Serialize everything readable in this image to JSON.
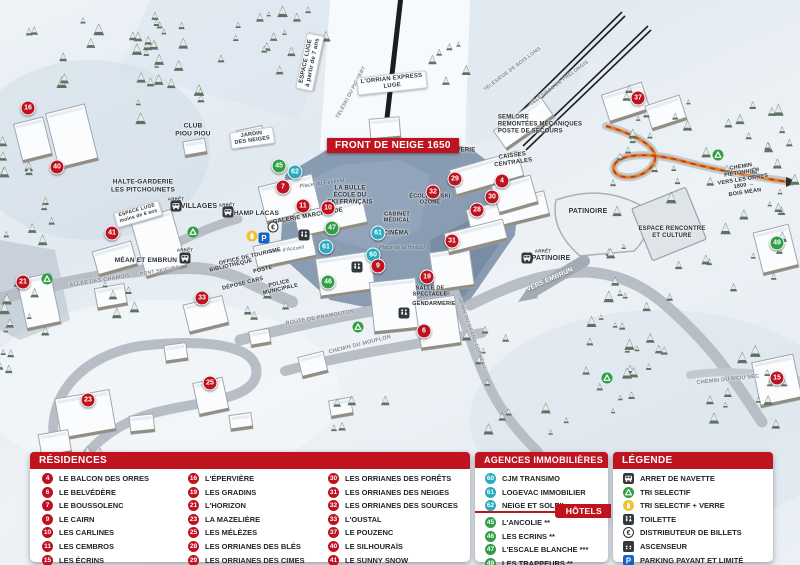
{
  "colors": {
    "red": "#bd1220",
    "teal": "#2aabbd",
    "green": "#2f9e45",
    "accent": "#c01320",
    "orange_path": "#e2801f"
  },
  "map": {
    "banner": "FRONT DE NEIGE 1650",
    "labels": [
      {
        "t": "ESPACE LUGE\nà partir de 7 ans",
        "x": 310,
        "y": 62,
        "rot": -78,
        "fs": 6,
        "cls": "s"
      },
      {
        "t": "TÉLÉSKI DU PIC VERT",
        "x": 352,
        "y": 93,
        "rot": -62,
        "fs": 5,
        "cls": "r"
      },
      {
        "t": "L'ORRIAN EXPRESS\nLUGE",
        "x": 392,
        "y": 83,
        "rot": -6,
        "fs": 6,
        "cls": "s"
      },
      {
        "t": "TÉLÉSIÈGE DE BOIS LONG",
        "x": 513,
        "y": 70,
        "rot": -37,
        "fs": 5,
        "cls": "r"
      },
      {
        "t": "TÉLÉSIÈGE DE PRÉLONGIS",
        "x": 560,
        "y": 84,
        "rot": -37,
        "fs": 5,
        "cls": "r"
      },
      {
        "t": "SEMLORE\nREMONTÉES MÉCANIQUES\nPOSTE DE SECOURS",
        "x": 540,
        "y": 125,
        "fs": 6,
        "cls": "d l"
      },
      {
        "t": "CLUB\nPIOU PIOU",
        "x": 193,
        "y": 130,
        "fs": 6.5,
        "cls": "d"
      },
      {
        "t": "JARDIN\nDES NEIGES",
        "x": 252,
        "y": 138,
        "rot": -8,
        "fs": 5.5,
        "cls": "s"
      },
      {
        "t": "HALTE-GARDERIE\nLES PITCHOUNETS",
        "x": 143,
        "y": 186,
        "fs": 6.5,
        "cls": "d"
      },
      {
        "t": "ESPACE LUGE\nmoins de 6 ans",
        "x": 138,
        "y": 214,
        "rot": -16,
        "fs": 5,
        "cls": "s"
      },
      {
        "t": "ARRÊT",
        "x": 176,
        "y": 199,
        "fs": 4.5,
        "cls": "a"
      },
      {
        "t": "VILLAGES",
        "x": 199,
        "y": 207,
        "fs": 7,
        "cls": "d"
      },
      {
        "t": "ARRÊT",
        "x": 227,
        "y": 205,
        "fs": 4.5,
        "cls": "a"
      },
      {
        "t": "CHAMP LACAS",
        "x": 254,
        "y": 214,
        "fs": 6.5,
        "cls": "d"
      },
      {
        "t": "Place du Festival",
        "x": 322,
        "y": 184,
        "rot": -8,
        "fs": 5.5,
        "cls": "i"
      },
      {
        "t": "LA BULLE\nÉCOLE DU\nSKI FRANÇAIS",
        "x": 350,
        "y": 196,
        "fs": 6,
        "cls": "d"
      },
      {
        "t": "GALERIE MARCHANDE",
        "x": 308,
        "y": 217,
        "rot": -10,
        "fs": 6,
        "cls": "d"
      },
      {
        "t": "CAISSES\nCENTRALES",
        "x": 513,
        "y": 160,
        "rot": -8,
        "fs": 6,
        "cls": "d"
      },
      {
        "t": "LAVERIE",
        "x": 462,
        "y": 151,
        "fs": 6,
        "cls": "d"
      },
      {
        "t": "ÉCOLE DE SKI\nOZONE",
        "x": 430,
        "y": 200,
        "fs": 5.5,
        "cls": "d"
      },
      {
        "t": "CABINET\nMÉDICAL",
        "x": 397,
        "y": 218,
        "fs": 5.5,
        "cls": "d"
      },
      {
        "t": "CINÉMA",
        "x": 396,
        "y": 234,
        "fs": 6,
        "cls": "d"
      },
      {
        "t": "Place de la Hodoul",
        "x": 402,
        "y": 249,
        "fs": 5,
        "cls": "i"
      },
      {
        "t": "Place d'Accueil",
        "x": 286,
        "y": 251,
        "rot": -8,
        "fs": 5,
        "cls": "i"
      },
      {
        "t": "OFFICE DE TOURISME",
        "x": 250,
        "y": 257,
        "rot": -13,
        "fs": 5.5,
        "cls": "d"
      },
      {
        "t": "BIBLIOTHÈQUE",
        "x": 231,
        "y": 266,
        "rot": -13,
        "fs": 5.5,
        "cls": "d"
      },
      {
        "t": "POSTE",
        "x": 263,
        "y": 270,
        "rot": -13,
        "fs": 5.5,
        "cls": "d"
      },
      {
        "t": "DÉPOSE CARS",
        "x": 243,
        "y": 284,
        "rot": -14,
        "fs": 5.5,
        "cls": "d"
      },
      {
        "t": "POLICE\nMUNICIPALE",
        "x": 280,
        "y": 287,
        "rot": -13,
        "fs": 5.5,
        "cls": "d"
      },
      {
        "t": "ARRÊT",
        "x": 185,
        "y": 250,
        "fs": 4.5,
        "cls": "a"
      },
      {
        "t": "MÉAN ET EMBRUN",
        "x": 146,
        "y": 261,
        "fs": 6.5,
        "cls": "d"
      },
      {
        "t": "PONT SKIEURS",
        "x": 160,
        "y": 272,
        "rot": -10,
        "fs": 5,
        "cls": "r"
      },
      {
        "t": "ALLÉE DES CHAMOIS",
        "x": 100,
        "y": 281,
        "rot": -9,
        "fs": 5.5,
        "cls": "r"
      },
      {
        "t": "ROUTE DE PRAMOUTON",
        "x": 320,
        "y": 318,
        "rot": -10,
        "fs": 5.5,
        "cls": "r"
      },
      {
        "t": "CHEMIN DU MOUFLON",
        "x": 360,
        "y": 345,
        "rot": -14,
        "fs": 5.5,
        "cls": "r"
      },
      {
        "t": "CHEMIN DU GRAND CORBEAU",
        "x": 470,
        "y": 332,
        "rot": 70,
        "fs": 5,
        "cls": "r"
      },
      {
        "t": "SALLE DE\nSPECTACLE",
        "x": 430,
        "y": 292,
        "fs": 5.5,
        "cls": "d"
      },
      {
        "t": "GENDARMERIE",
        "x": 434,
        "y": 304,
        "fs": 5.5,
        "cls": "d"
      },
      {
        "t": "PATINOIRE",
        "x": 588,
        "y": 212,
        "fs": 7,
        "cls": "d"
      },
      {
        "t": "ARRÊT",
        "x": 543,
        "y": 251,
        "fs": 4.5,
        "cls": "a"
      },
      {
        "t": "PATINOIRE",
        "x": 551,
        "y": 259,
        "fs": 7,
        "cls": "d"
      },
      {
        "t": "ESPACE RENCONTRE\nET CULTURE",
        "x": 672,
        "y": 233,
        "fs": 6,
        "cls": "d"
      },
      {
        "t": "VERS EMBRUN",
        "x": 550,
        "y": 280,
        "rot": -24,
        "fs": 6.5,
        "cls": "w"
      },
      {
        "t": "CHEMIN PIÉTONNIER\nVERS LES ORRES 1800 →\nBOIS MÉAN",
        "x": 743,
        "y": 180,
        "rot": -9,
        "fs": 5.5,
        "cls": "d"
      },
      {
        "t": "CHEMIN DU RIOU SEC",
        "x": 728,
        "y": 380,
        "rot": -6,
        "fs": 5.5,
        "cls": "r"
      }
    ],
    "markers": [
      {
        "n": "16",
        "x": 28,
        "y": 108,
        "c": "red"
      },
      {
        "n": "40",
        "x": 57,
        "y": 167,
        "c": "red"
      },
      {
        "n": "41",
        "x": 112,
        "y": 233,
        "c": "red"
      },
      {
        "n": "21",
        "x": 23,
        "y": 282,
        "c": "red"
      },
      {
        "n": "33",
        "x": 202,
        "y": 298,
        "c": "red"
      },
      {
        "n": "23",
        "x": 88,
        "y": 400,
        "c": "red"
      },
      {
        "n": "25",
        "x": 210,
        "y": 383,
        "c": "red"
      },
      {
        "n": "45",
        "x": 279,
        "y": 166,
        "c": "green"
      },
      {
        "n": "62",
        "x": 295,
        "y": 172,
        "c": "teal"
      },
      {
        "n": "7",
        "x": 283,
        "y": 187,
        "c": "red"
      },
      {
        "n": "11",
        "x": 303,
        "y": 206,
        "c": "red"
      },
      {
        "n": "10",
        "x": 328,
        "y": 208,
        "c": "red"
      },
      {
        "n": "47",
        "x": 332,
        "y": 228,
        "c": "green"
      },
      {
        "n": "61",
        "x": 326,
        "y": 247,
        "c": "teal"
      },
      {
        "n": "61",
        "x": 378,
        "y": 233,
        "c": "teal"
      },
      {
        "n": "60",
        "x": 373,
        "y": 255,
        "c": "teal"
      },
      {
        "n": "9",
        "x": 378,
        "y": 266,
        "c": "red"
      },
      {
        "n": "46",
        "x": 328,
        "y": 282,
        "c": "green"
      },
      {
        "n": "19",
        "x": 427,
        "y": 277,
        "c": "red"
      },
      {
        "n": "6",
        "x": 424,
        "y": 331,
        "c": "red"
      },
      {
        "n": "31",
        "x": 452,
        "y": 241,
        "c": "red"
      },
      {
        "n": "32",
        "x": 433,
        "y": 192,
        "c": "red"
      },
      {
        "n": "29",
        "x": 455,
        "y": 179,
        "c": "red"
      },
      {
        "n": "28",
        "x": 477,
        "y": 210,
        "c": "red"
      },
      {
        "n": "30",
        "x": 492,
        "y": 197,
        "c": "red"
      },
      {
        "n": "4",
        "x": 502,
        "y": 181,
        "c": "red"
      },
      {
        "n": "37",
        "x": 638,
        "y": 98,
        "c": "red"
      },
      {
        "n": "49",
        "x": 777,
        "y": 243,
        "c": "green"
      },
      {
        "n": "15",
        "x": 777,
        "y": 378,
        "c": "red"
      }
    ],
    "icons": [
      {
        "t": "bus",
        "x": 185,
        "y": 258
      },
      {
        "t": "bus",
        "x": 176,
        "y": 206
      },
      {
        "t": "bus",
        "x": 228,
        "y": 212
      },
      {
        "t": "bus",
        "x": 527,
        "y": 258
      },
      {
        "t": "recycle",
        "x": 47,
        "y": 279
      },
      {
        "t": "recycle",
        "x": 193,
        "y": 232
      },
      {
        "t": "recycle",
        "x": 358,
        "y": 327
      },
      {
        "t": "recycle",
        "x": 718,
        "y": 155
      },
      {
        "t": "recycle",
        "x": 607,
        "y": 378
      },
      {
        "t": "yellow",
        "x": 252,
        "y": 236
      },
      {
        "t": "parking",
        "x": 264,
        "y": 238
      },
      {
        "t": "euro",
        "x": 273,
        "y": 227
      },
      {
        "t": "wc",
        "x": 304,
        "y": 235
      },
      {
        "t": "wc",
        "x": 357,
        "y": 267
      },
      {
        "t": "wc",
        "x": 404,
        "y": 313
      }
    ]
  },
  "legend": {
    "residences": {
      "title": "RÉSIDENCES",
      "columns": [
        [
          {
            "n": "4",
            "label": "LE BALCON DES ORRES"
          },
          {
            "n": "6",
            "label": "LE BELVÉDÈRE"
          },
          {
            "n": "7",
            "label": "LE BOUSSOLENC"
          },
          {
            "n": "9",
            "label": "LE CAIRN"
          },
          {
            "n": "10",
            "label": "LES CARLINES"
          },
          {
            "n": "11",
            "label": "LES CEMBROS"
          },
          {
            "n": "15",
            "label": "LES ÉCRINS"
          }
        ],
        [
          {
            "n": "16",
            "label": "L'ÉPERVIÈRE"
          },
          {
            "n": "19",
            "label": "LES GRADINS"
          },
          {
            "n": "21",
            "label": "L'HORIZON"
          },
          {
            "n": "23",
            "label": "LA MAZELIÈRE"
          },
          {
            "n": "25",
            "label": "LES MÉLÈZES"
          },
          {
            "n": "28",
            "label": "LES ORRIANES DES BLÉS"
          },
          {
            "n": "29",
            "label": "LES ORRIANES DES CIMES"
          }
        ],
        [
          {
            "n": "30",
            "label": "LES ORRIANES DES FORÊTS"
          },
          {
            "n": "31",
            "label": "LES ORRIANES DES NEIGES"
          },
          {
            "n": "32",
            "label": "LES ORRIANES DES SOURCES"
          },
          {
            "n": "33",
            "label": "L'OUSTAL"
          },
          {
            "n": "37",
            "label": "LE POUZENC"
          },
          {
            "n": "40",
            "label": "LE SILHOURAÏS"
          },
          {
            "n": "41",
            "label": "LE SUNNY SNOW"
          }
        ]
      ]
    },
    "agences": {
      "title": "AGENCES IMMOBILIÈRES",
      "items": [
        {
          "n": "60",
          "label": "CJM TRANSIMO"
        },
        {
          "n": "61",
          "label": "LOGEVAC IMMOBILIER"
        },
        {
          "n": "62",
          "label": "NEIGE ET SOLEIL"
        }
      ]
    },
    "hotels": {
      "title": "HÔTELS",
      "items": [
        {
          "n": "45",
          "label": "L'ANCOLIE **"
        },
        {
          "n": "46",
          "label": "LES ECRINS **"
        },
        {
          "n": "47",
          "label": "L'ESCALE BLANCHE ***"
        },
        {
          "n": "49",
          "label": "LES TRAPPEURS **"
        }
      ]
    },
    "legende": {
      "title": "LÉGENDE",
      "items": [
        {
          "icon": "bus",
          "label": "ARRET DE NAVETTE"
        },
        {
          "icon": "recycle",
          "label": "TRI SELECTIF"
        },
        {
          "icon": "yellow",
          "label": "TRI SELECTIF + VERRE"
        },
        {
          "icon": "wc",
          "label": "TOILETTE"
        },
        {
          "icon": "euro",
          "label": "DISTRIBUTEUR DE BILLETS"
        },
        {
          "icon": "elevator",
          "label": "ASCENSEUR"
        },
        {
          "icon": "parking",
          "label": "PARKING PAYANT ET LIMITÉ"
        }
      ]
    }
  }
}
